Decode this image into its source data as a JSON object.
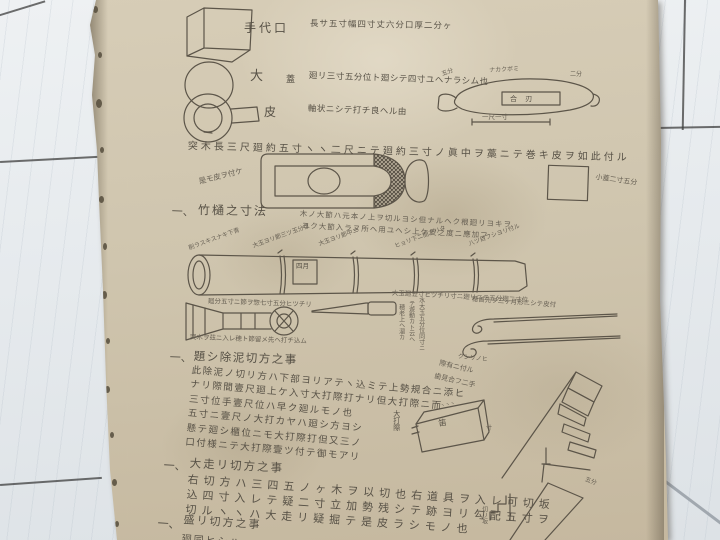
{
  "colors": {
    "paper": "#cfc5ae",
    "ink": "#575146",
    "floor": "#e9ecef"
  },
  "paper": {
    "row1": {
      "label": "手代口",
      "text": "長サ五寸幅四寸丈六分口厚二分ヶ"
    },
    "row2": {
      "label": "大",
      "label2": "蓋",
      "text": "廻リ三寸五分位ト廻シテ四寸ユヘナラシム也"
    },
    "row3": {
      "label": "皮",
      "text": "軸状ニシテ打チ良ヘル由"
    },
    "spindle": {
      "top": "ナカクボミ",
      "left": "五分",
      "right": "二分",
      "inner": "合 刃",
      "bottom": "一尺一寸"
    },
    "tsukigi": "突木長三尺廻約五寸ヽヽ二尺ニテ廻約三寸ノ眞中ヲ藁ニテ巻キ皮ヲ如此付ル",
    "kore": "是モ皮ヲ付ケ",
    "kobako": "小蓋二寸五分",
    "sec1": {
      "num": "一、",
      "title": "竹樋之寸法",
      "note1": "木ノ大節ハ元本ノ上ヲ切ルヨシ但ナルヘク根廻リヨキヲ",
      "note2": "ヨク大節入ラヌ所ヘ用ユヘシ上ケ皮之度ニ應加フ",
      "ann1": "削ラスキスナキ下青",
      "ann2": "大玉ヨリ節三ツ玉分位",
      "ann3": "大玉ヨリ節中ニ",
      "ann4": "ヒョリ下ニ間アリタ",
      "ann5": "八ツ目フシヨリ付ル",
      "stamp": "四月",
      "under1": "廻分五寸ニ節ヲ惣七寸五分ヒツチリ",
      "under2": "大玉廻五寸ヒツチリ寸ニ廻リニテ五分廻二寸位",
      "tool_note": "突木ヲ茲ニ入レ穂ト節留メ先ヘ打チ込ム",
      "col1": "水大玉五分位同寸ニ",
      "col2": "テ遊動カト云ヘ",
      "col3": "穂老上ヘ溜カ",
      "hook_note": "穂首先ヲ三ヶ月形ニシテ皮付",
      "hook_note2": "クシリノヒ"
    },
    "sec2": {
      "num": "一、",
      "title": "題シ除泥切方之事",
      "lines": [
        "此除泥ノ切リ方ハ下部ヨリアテヽ込ミテ上勢規合ニ添ヒ",
        "ナリ際間壹尺廻上ケ入寸大打際打ナリ但大打際ニ而",
        "三寸位手壹尺位ハ早ク廻ルモノ也",
        "五寸ニ壹尺ノ大打カヤハ廻シ方ヨシ",
        "懸テ廻シ櫃位ニモ大打際打但又三ノ",
        "口付様ニテ大打際壹ツ付テ御モアリ"
      ],
      "side1": "際有ニ付ル",
      "side2": "歯見合フ二手",
      "wedge_label": "大打際",
      "wedge_inner": "笛",
      "wedge_marks": "ヽヽヽ",
      "wedge_right": "寸"
    },
    "sec3": {
      "num": "一、",
      "title": "大走リ切方之事",
      "lines": [
        "右切方ハ三四五ノヶ木ヲ以切也右道具ヲ入レ可切坂",
        "込四寸入レテ疑二寸立加勢残シテ跡ヨリ勾配五寸ヲ",
        "切ルヽヽハ大走リ疑掘テ是皮ラシモノ也"
      ]
    },
    "sec4": {
      "num": "一、",
      "title": "盛リ切方之事",
      "partial": "廻同ヒシハ"
    },
    "br": {
      "label": "五分",
      "small": "切リ坂"
    }
  }
}
